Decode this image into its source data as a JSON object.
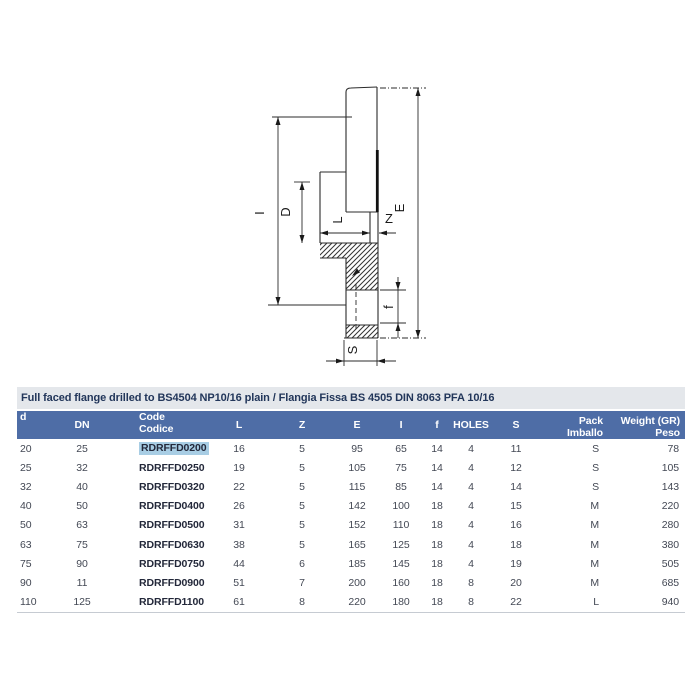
{
  "title": "Full faced flange drilled to BS4504 NP10/16 plain / Flangia Fissa BS 4505 DIN 8063 PFA 10/16",
  "colors": {
    "header_bg": "#4e6da6",
    "title_bg": "#e4e7eb",
    "title_text": "#22365a",
    "code_highlight": "#a8cde4"
  },
  "drawing": {
    "labels": {
      "I": "I",
      "D": "D",
      "L": "L",
      "Z": "Z",
      "E": "E",
      "f": "f",
      "S": "S"
    }
  },
  "table": {
    "headers": [
      {
        "l1": "d"
      },
      {
        "l1": "DN"
      },
      {
        "l1": "Code",
        "l2": "Codice"
      },
      {
        "l1": "L"
      },
      {
        "l1": "Z"
      },
      {
        "l1": "E"
      },
      {
        "l1": "I"
      },
      {
        "l1": "f"
      },
      {
        "l1": "HOLES"
      },
      {
        "l1": "S"
      },
      {
        "l1": "Pack",
        "l2": "Imballo"
      },
      {
        "l1": "Weight (GR)",
        "l2": "Peso"
      }
    ],
    "rows": [
      [
        "20",
        "25",
        "RDRFFD0200",
        "16",
        "5",
        "95",
        "65",
        "14",
        "4",
        "11",
        "S",
        "78"
      ],
      [
        "25",
        "32",
        "RDRFFD0250",
        "19",
        "5",
        "105",
        "75",
        "14",
        "4",
        "12",
        "S",
        "105"
      ],
      [
        "32",
        "40",
        "RDRFFD0320",
        "22",
        "5",
        "115",
        "85",
        "14",
        "4",
        "14",
        "S",
        "143"
      ],
      [
        "40",
        "50",
        "RDRFFD0400",
        "26",
        "5",
        "142",
        "100",
        "18",
        "4",
        "15",
        "M",
        "220"
      ],
      [
        "50",
        "63",
        "RDRFFD0500",
        "31",
        "5",
        "152",
        "110",
        "18",
        "4",
        "16",
        "M",
        "280"
      ],
      [
        "63",
        "75",
        "RDRFFD0630",
        "38",
        "5",
        "165",
        "125",
        "18",
        "4",
        "18",
        "M",
        "380"
      ],
      [
        "75",
        "90",
        "RDRFFD0750",
        "44",
        "6",
        "185",
        "145",
        "18",
        "4",
        "19",
        "M",
        "505"
      ],
      [
        "90",
        "11",
        "RDRFFD0900",
        "51",
        "7",
        "200",
        "160",
        "18",
        "8",
        "20",
        "M",
        "685"
      ],
      [
        "110",
        "125",
        "RDRFFD1100",
        "61",
        "8",
        "220",
        "180",
        "18",
        "8",
        "22",
        "L",
        "940"
      ]
    ],
    "highlight": {
      "row": 0,
      "col": 2
    }
  }
}
